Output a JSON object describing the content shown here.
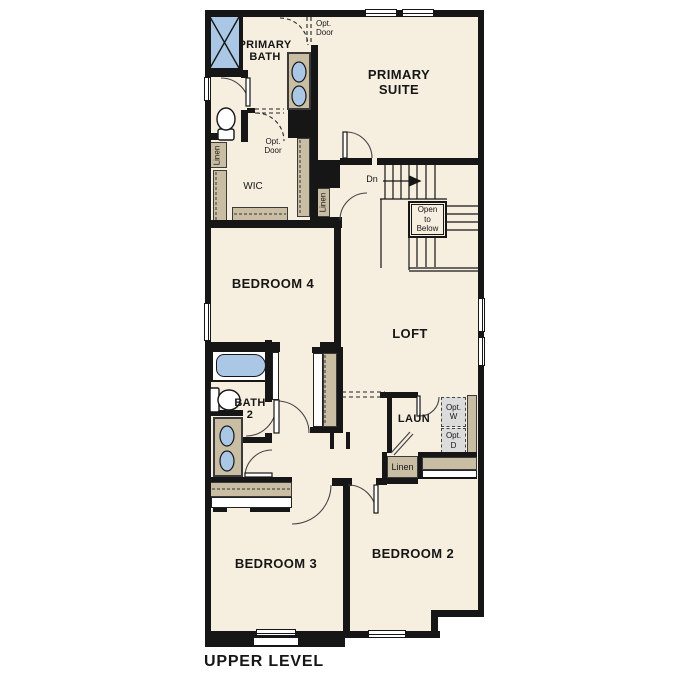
{
  "plan_title": "UPPER LEVEL",
  "rooms": {
    "primary_suite": {
      "line1": "PRIMARY",
      "line2": "SUITE"
    },
    "primary_bath": {
      "line1": "PRIMARY",
      "line2": "BATH"
    },
    "wic": {
      "label": "WIC"
    },
    "bedroom4": {
      "label": "BEDROOM 4"
    },
    "loft": {
      "label": "LOFT"
    },
    "bath2": {
      "line1": "BATH",
      "line2": "2"
    },
    "laundry": {
      "label": "LAUN"
    },
    "bedroom3": {
      "label": "BEDROOM 3"
    },
    "bedroom2": {
      "label": "BEDROOM 2"
    }
  },
  "annotations": {
    "opt_door_upper": {
      "line1": "Opt.",
      "line2": "Door"
    },
    "opt_door_wic": {
      "line1": "Opt.",
      "line2": "Door"
    },
    "stairs_down": "Dn",
    "open_to_below": {
      "line1": "Open",
      "line2": "to",
      "line3": "Below"
    },
    "linen_wic": "Linen",
    "linen_hall": "Linen",
    "linen_laundry": "Linen",
    "optional_washer": {
      "line1": "Opt.",
      "line2": "W"
    },
    "optional_dryer": {
      "line1": "Opt.",
      "line2": "D"
    }
  },
  "colors": {
    "background": "#ffffff",
    "floor": "#f6efe0",
    "wall": "#161616",
    "casework_tan": "#c9bda3",
    "fixture_blue": "#aac8e6",
    "optional_appliance_gray": "#dcdcdc"
  }
}
